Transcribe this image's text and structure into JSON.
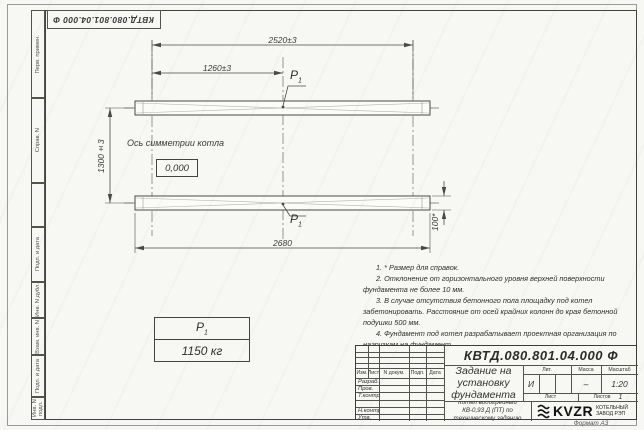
{
  "sheet": {
    "stamp_rotated": "КВТД.080.801.04.000  Ф",
    "format_label": "Формат А3"
  },
  "margin_labels": [
    "Перв. примен.",
    "Справ. N",
    "",
    "Подп. и дата",
    "Инв. N дубл.",
    "Взам. инв. N",
    "Подп. и дата",
    "Инв. N подл."
  ],
  "drawing": {
    "dims": {
      "top": "2520±3",
      "half": "1260±3",
      "vertical": "1300±3",
      "bottom": "2680",
      "height": "100*"
    },
    "load_point": {
      "symbol": "P",
      "index": "1"
    },
    "axis_label": "Ось симметрии котла",
    "elevation_mark": "0,000"
  },
  "load_table": {
    "symbol": "P",
    "index": "1",
    "value": "1150 кг"
  },
  "notes": [
    "1. * Размер для справок.",
    "2. Отклонение от горизонтального уровня верхней поверхности фундамента не более 10 мм.",
    "3. В случае отсутствия бетонного пола площадку под котел забетонировать. Расстояние от осей крайних колонн до края бетонной подушки 500 мм.",
    "4. Фундамент под котел разрабатывает проектная организация по нагрузкам на фундамент."
  ],
  "title_block": {
    "designation": "КВТД.080.801.04.000  Ф",
    "document_title": "Задание на установку фундамента",
    "subject": "Котел водогрейный КВ-0,93 Д (ПТ) по техническому заданию",
    "header_cols": [
      "Изм.",
      "Лист",
      "N докум.",
      "Подп.",
      "Дата"
    ],
    "row_labels": [
      "Разраб.",
      "Пров.",
      "Т.контр.",
      "",
      "Н.контр.",
      "Утв."
    ],
    "lit_label": "Лит.",
    "lit_value": "И",
    "mass_label": "Масса",
    "mass_value": "–",
    "scale_label": "Масштаб",
    "scale_value": "1:20",
    "sheet_label": "Лист",
    "sheets_label": "Листов",
    "sheets_value": "1",
    "company_short": "KVZR",
    "company_name": "КОТЕЛЬНЫЙ ЗАВОД РЭП"
  }
}
